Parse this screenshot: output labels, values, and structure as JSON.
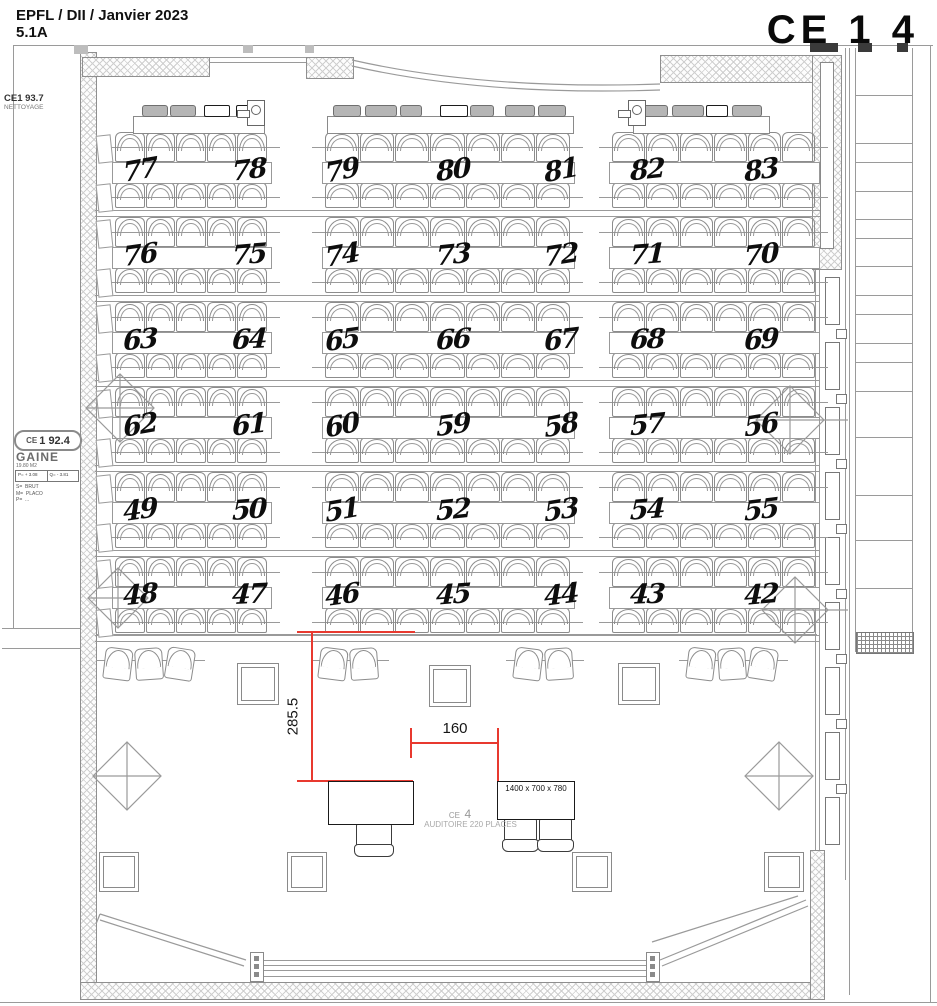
{
  "header": {
    "project_line": "EPFL / DII / Janvier 2023",
    "sheet_code": "5.1A",
    "room_title": "CE 1 4"
  },
  "side_labels": {
    "nettoyage": {
      "code": "CE1 93.7",
      "name": "NETTOYAGE"
    },
    "gaine": {
      "code_prefix": "CE",
      "code": "1 92.4",
      "name": "GAINE",
      "area": "19.80 M2",
      "cell_left": "P= + 3.08",
      "cell_right": "Q= - 3.81",
      "spec_lines": "S=  BRUT\nM=  PLACO\nP=  ..."
    }
  },
  "seating": {
    "desk_rows": [
      {
        "numbers": [
          "77",
          "78",
          "79",
          "80",
          "81",
          "82",
          "83"
        ]
      },
      {
        "numbers": [
          "76",
          "75",
          "74",
          "73",
          "72",
          "71",
          "70"
        ]
      },
      {
        "numbers": [
          "63",
          "64",
          "65",
          "66",
          "67",
          "68",
          "69"
        ]
      },
      {
        "numbers": [
          "62",
          "61",
          "60",
          "59",
          "58",
          "57",
          "56"
        ]
      },
      {
        "numbers": [
          "49",
          "50",
          "51",
          "52",
          "53",
          "54",
          "55"
        ]
      },
      {
        "numbers": [
          "48",
          "47",
          "46",
          "45",
          "44",
          "43",
          "42"
        ]
      }
    ]
  },
  "dimensions": {
    "vertical_label": "285.5",
    "horizontal_label": "160",
    "accent_color": "#e8392f"
  },
  "front_area": {
    "table_dims_label": "1400 x 700 x 780",
    "room_code_prefix": "CE",
    "room_code": "4",
    "room_caption": "AUDITOIRE 220 PLACES"
  }
}
